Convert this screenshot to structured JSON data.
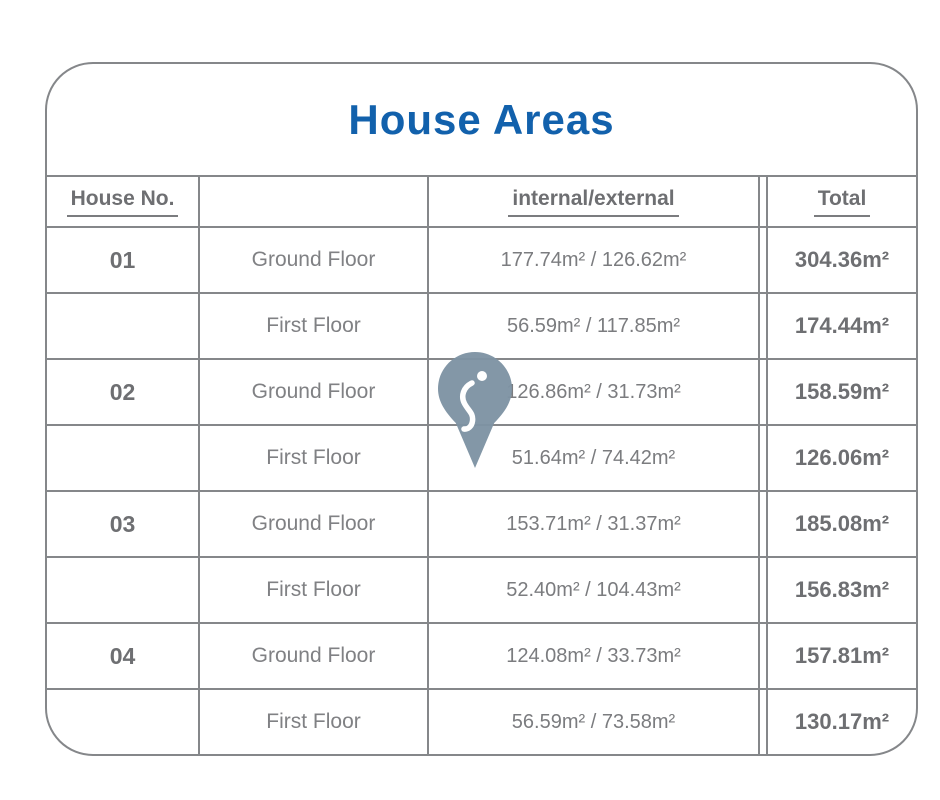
{
  "title": "House Areas",
  "colors": {
    "title_blue": "#1261ac",
    "border_gray": "#85878a",
    "heading_text_gray": "#6e6f72",
    "value_text_gray": "#7b7c7f",
    "pin_fill": "#7e93a3"
  },
  "icons": {
    "map_pin": "location-pin-icon"
  },
  "table": {
    "headers": {
      "house_no": "House No.",
      "floor": "",
      "internal_external": "internal/external",
      "total": "Total"
    },
    "rows": [
      {
        "house_no": "01",
        "floor": "Ground Floor",
        "internal_external": "177.74m² / 126.62m²",
        "total": "304.36m²"
      },
      {
        "house_no": "",
        "floor": "First Floor",
        "internal_external": "56.59m² / 117.85m²",
        "total": "174.44m²"
      },
      {
        "house_no": "02",
        "floor": "Ground Floor",
        "internal_external": "126.86m² / 31.73m²",
        "total": "158.59m²"
      },
      {
        "house_no": "",
        "floor": "First Floor",
        "internal_external": "51.64m² / 74.42m²",
        "total": "126.06m²"
      },
      {
        "house_no": "03",
        "floor": "Ground Floor",
        "internal_external": "153.71m² / 31.37m²",
        "total": "185.08m²"
      },
      {
        "house_no": "",
        "floor": "First Floor",
        "internal_external": "52.40m² / 104.43m²",
        "total": "156.83m²"
      },
      {
        "house_no": "04",
        "floor": "Ground Floor",
        "internal_external": "124.08m² / 33.73m²",
        "total": "157.81m²"
      },
      {
        "house_no": "",
        "floor": "First Floor",
        "internal_external": "56.59m² / 73.58m²",
        "total": "130.17m²"
      }
    ]
  },
  "chart_data": {
    "type": "table",
    "title": "House Areas",
    "columns": [
      "House No.",
      "",
      "internal/external",
      "Total"
    ],
    "rows": [
      [
        "01",
        "Ground Floor",
        "177.74m² / 126.62m²",
        "304.36m²"
      ],
      [
        "",
        "First Floor",
        "56.59m² / 117.85m²",
        "174.44m²"
      ],
      [
        "02",
        "Ground Floor",
        "126.86m² / 31.73m²",
        "158.59m²"
      ],
      [
        "",
        "First Floor",
        "51.64m² / 74.42m²",
        "126.06m²"
      ],
      [
        "03",
        "Ground Floor",
        "153.71m² / 31.37m²",
        "185.08m²"
      ],
      [
        "",
        "First Floor",
        "52.40m² / 104.43m²",
        "156.83m²"
      ],
      [
        "04",
        "Ground Floor",
        "124.08m² / 33.73m²",
        "157.81m²"
      ],
      [
        "",
        "First Floor",
        "56.59m² / 73.58m²",
        "130.17m²"
      ]
    ]
  }
}
